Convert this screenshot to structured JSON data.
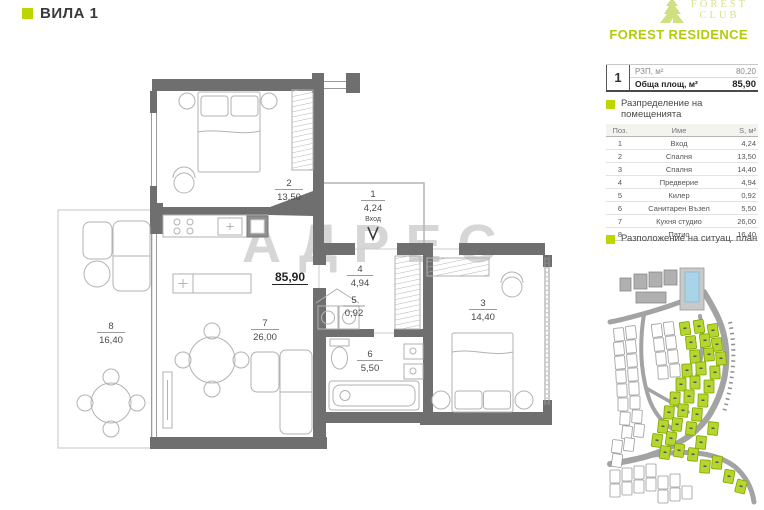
{
  "colors": {
    "accent": "#bdd500",
    "wall_gray": "#6f6f6f",
    "logo_light_green": "#d6e38c",
    "residence_green": "#b3cc0a",
    "site_lot_green": "#b5d62e",
    "pool_blue": "#a9d3e8"
  },
  "header": {
    "title": "ВИЛА 1"
  },
  "logo": {
    "club_line1": "FOREST",
    "club_line2": "CLUB",
    "residence": "FOREST RESIDENCE"
  },
  "summary": {
    "unit_no": "1",
    "rzp_label": "РЗП, м²",
    "rzp_value": "80,20",
    "total_label": "Обща площ, м²",
    "total_value": "85,90"
  },
  "rooms_section": {
    "heading": "Разпределение на помещенията",
    "columns": [
      "Поз.",
      "Име",
      "S, м²"
    ],
    "rows": [
      [
        "1",
        "Вход",
        "4,24"
      ],
      [
        "2",
        "Спалня",
        "13,50"
      ],
      [
        "3",
        "Спалня",
        "14,40"
      ],
      [
        "4",
        "Предверие",
        "4,94"
      ],
      [
        "5",
        "Килер",
        "0,92"
      ],
      [
        "6",
        "Санитарен Възел",
        "5,50"
      ],
      [
        "7",
        "Кухня студио",
        "26,00"
      ],
      [
        "8",
        "Патио",
        "16,40"
      ]
    ]
  },
  "siteplan_section": {
    "heading": "Разположение на ситуац. план"
  },
  "plan": {
    "total_area_label": "85,90",
    "entrance_label": "Вход",
    "watermark": "АДРЕС",
    "rooms": [
      {
        "num": "1",
        "area": "4,24"
      },
      {
        "num": "2",
        "area": "13,50"
      },
      {
        "num": "3",
        "area": "14,40"
      },
      {
        "num": "4",
        "area": "4,94"
      },
      {
        "num": "5",
        "area": "0,92"
      },
      {
        "num": "6",
        "area": "5,50"
      },
      {
        "num": "7",
        "area": "26,00"
      },
      {
        "num": "8",
        "area": "16,40"
      }
    ]
  }
}
